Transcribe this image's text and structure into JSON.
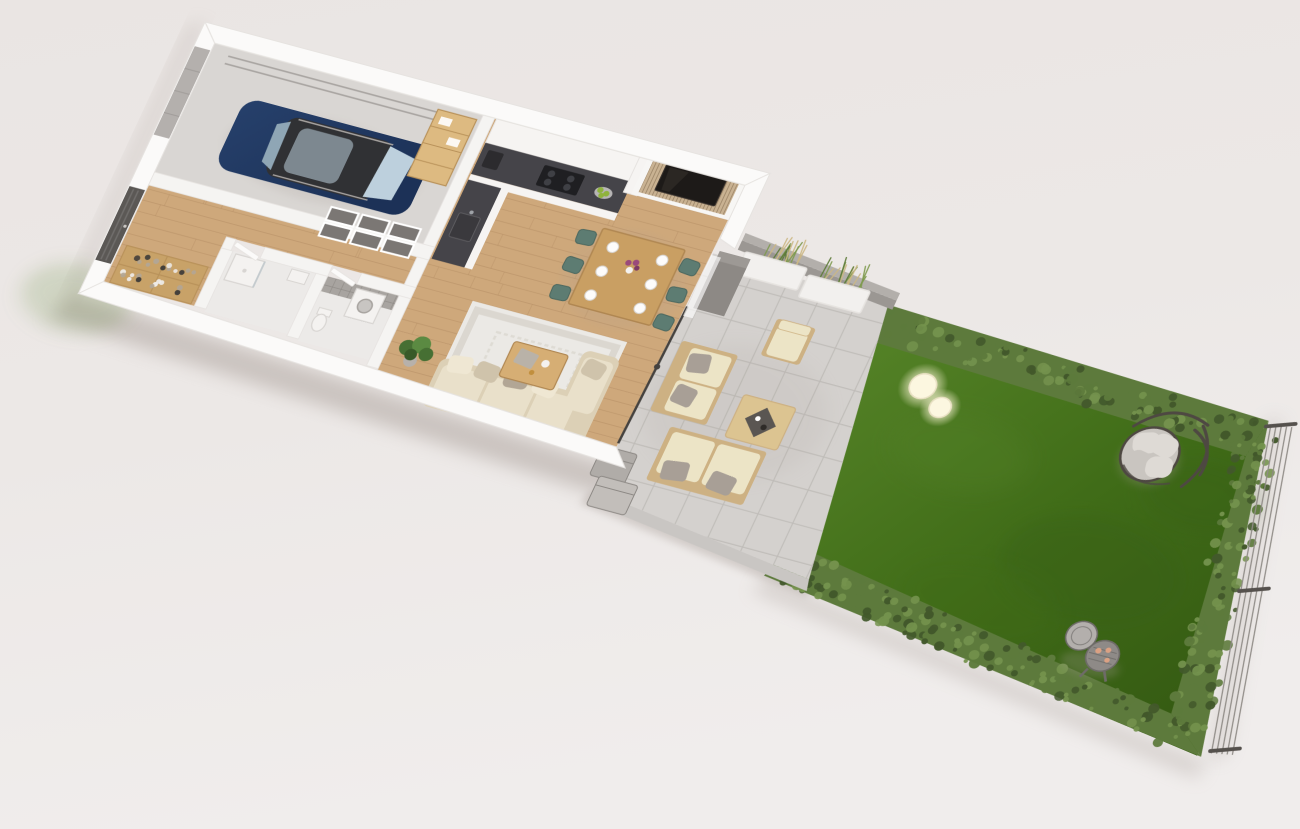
{
  "scene": {
    "kind": "3d-floor-plan-render",
    "view": "isometric cutaway of a single-storey house with garage, open-plan kitchen/living room, patio and fenced garden lawn"
  },
  "colors": {
    "bg_top": "#eae5e3",
    "bg_mid": "#ece8e6",
    "bg_bottom": "#f0edec",
    "shadow": "#a89e98",
    "wall_white": "#fbfaf9",
    "wall_edge": "#e6e3e0",
    "inner_wall": "#f5f4f2",
    "garage_floor": "#d9d6d3",
    "garage_door": "#b4b0ad",
    "garage_door_line": "#a19d9a",
    "rail_gray": "#a8a4a1",
    "car_body": "#26406b",
    "car_body_dark": "#1c3157",
    "car_roof": "#303134",
    "car_glass": "#bdd0dd",
    "car_glass_dark": "#8fa6b5",
    "shelf_pine": "#ddba81",
    "shelf_line": "#b9925a",
    "door_dark": "#5b5855",
    "rack_wood": "#c8a268",
    "shoe_dark": "#3c3a38",
    "shoe_light": "#efedeb",
    "frame_img": "#7b7774",
    "wood_floor": "#cea87b",
    "wood_line": "#a9815a",
    "room_floor": "#eceae8",
    "tile_wall": "#a8a4a0",
    "fixture_white": "#f4f2f0",
    "fixture_edge": "#d8d5d2",
    "washer_drum": "#c8c5c2",
    "cabinet_white": "#f6f4f2",
    "counter_dark": "#454449",
    "cooktop_black": "#1f1f22",
    "appliance_dark": "#2c2b2e",
    "apple_green": "#8fb33c",
    "slat_frame": "#f7f6f4",
    "slat_base": "#c9b292",
    "slat_gap": "#9c8467",
    "tv_black": "#1d1a18",
    "tv_sheen": "#3a332e",
    "table_wood": "#c99f63",
    "table_edge": "#b08752",
    "chair_teal": "#5d7c72",
    "chair_teal_dark": "#4c685f",
    "plate_white": "#fdfcfb",
    "flower_purple": "#9a4a7b",
    "rug": "#ebe9e5",
    "rug_border": "#d8d4cd",
    "sofa_base": "#dcd0b6",
    "cushion_cream": "#e9e0ca",
    "pillow_light": "#efe7d3",
    "pillow_mid": "#cfc3ab",
    "pillow_gray": "#b2a695",
    "coffee_wood": "#d6ae74",
    "cloth_gray": "#b9b2a8",
    "gold": "#c18f3d",
    "plant_green": "#466f33",
    "plant_green_light": "#5b8a42",
    "pot_gray": "#b7b1ab",
    "glass_pole": "#45423f",
    "curtain": "#ffffff",
    "column_gray": "#8d8985",
    "column_top": "#9d9995",
    "tile": "#d4d1ce",
    "tile_grout": "#bfbcb9",
    "curb": "#c9c6c3",
    "planter_wall_top": "#b3afab",
    "planter_wall_face": "#9b9793",
    "planter_white": "#f2f0ee",
    "grass_green": "#7e9a4e",
    "grass_dark": "#5d7a38",
    "grass_tan": "#cbb784",
    "out_wood": "#cdb183",
    "out_wood_pale": "#dcc491",
    "out_cushion": "#ece4c6",
    "out_pillow": "#a89f96",
    "tray_dark": "#5a5652",
    "box_gray1": "#b0aca8",
    "box_gray2": "#c2beba",
    "lawn_light": "#538126",
    "lawn_dark": "#3f6b17",
    "lawn_deep": "#365c13",
    "hedge": "#5d7a3c",
    "hedge_light": "#74924d",
    "hedge_dark": "#42582b",
    "trellis_wire": "#8f8b86",
    "trellis_post": "#55514d",
    "lamp_core": "#fcf7e0",
    "lamp_rim": "#e9e1c4",
    "egg_frame": "#4e4842",
    "egg_cushion": "#dedad5",
    "egg_cushion_dark": "#c9c5c0",
    "grill_lid": "#b3afac",
    "grill_body": "#8e8a87",
    "grill_dark": "#6e6b68",
    "food_pink": "#dba183",
    "white": "#ffffff"
  },
  "objects": [
    {
      "id": "garage",
      "label": "garage with parked dark-blue car, door tracks and pine shelving"
    },
    {
      "id": "entry",
      "label": "entry hall with dark front door and shoe rack"
    },
    {
      "id": "bathrooms",
      "label": "two small rooms: shower room and tiled bathroom with washer and toilet"
    },
    {
      "id": "kitchen",
      "label": "white L-shaped kitchen with dark countertop and cooktop"
    },
    {
      "id": "media-wall",
      "label": "wood slat media wall with mounted TV"
    },
    {
      "id": "dining",
      "label": "wooden dining table with six teal chairs, plates and flowers"
    },
    {
      "id": "living",
      "label": "beige corner sofa on patterned rug with coffee table and plant"
    },
    {
      "id": "patio",
      "label": "tiled patio with outdoor lounge set, planters and storage boxes"
    },
    {
      "id": "garden",
      "label": "hedged lawn with sphere lamps, hanging egg chair, barbecue grill and wire trellis fence"
    }
  ]
}
